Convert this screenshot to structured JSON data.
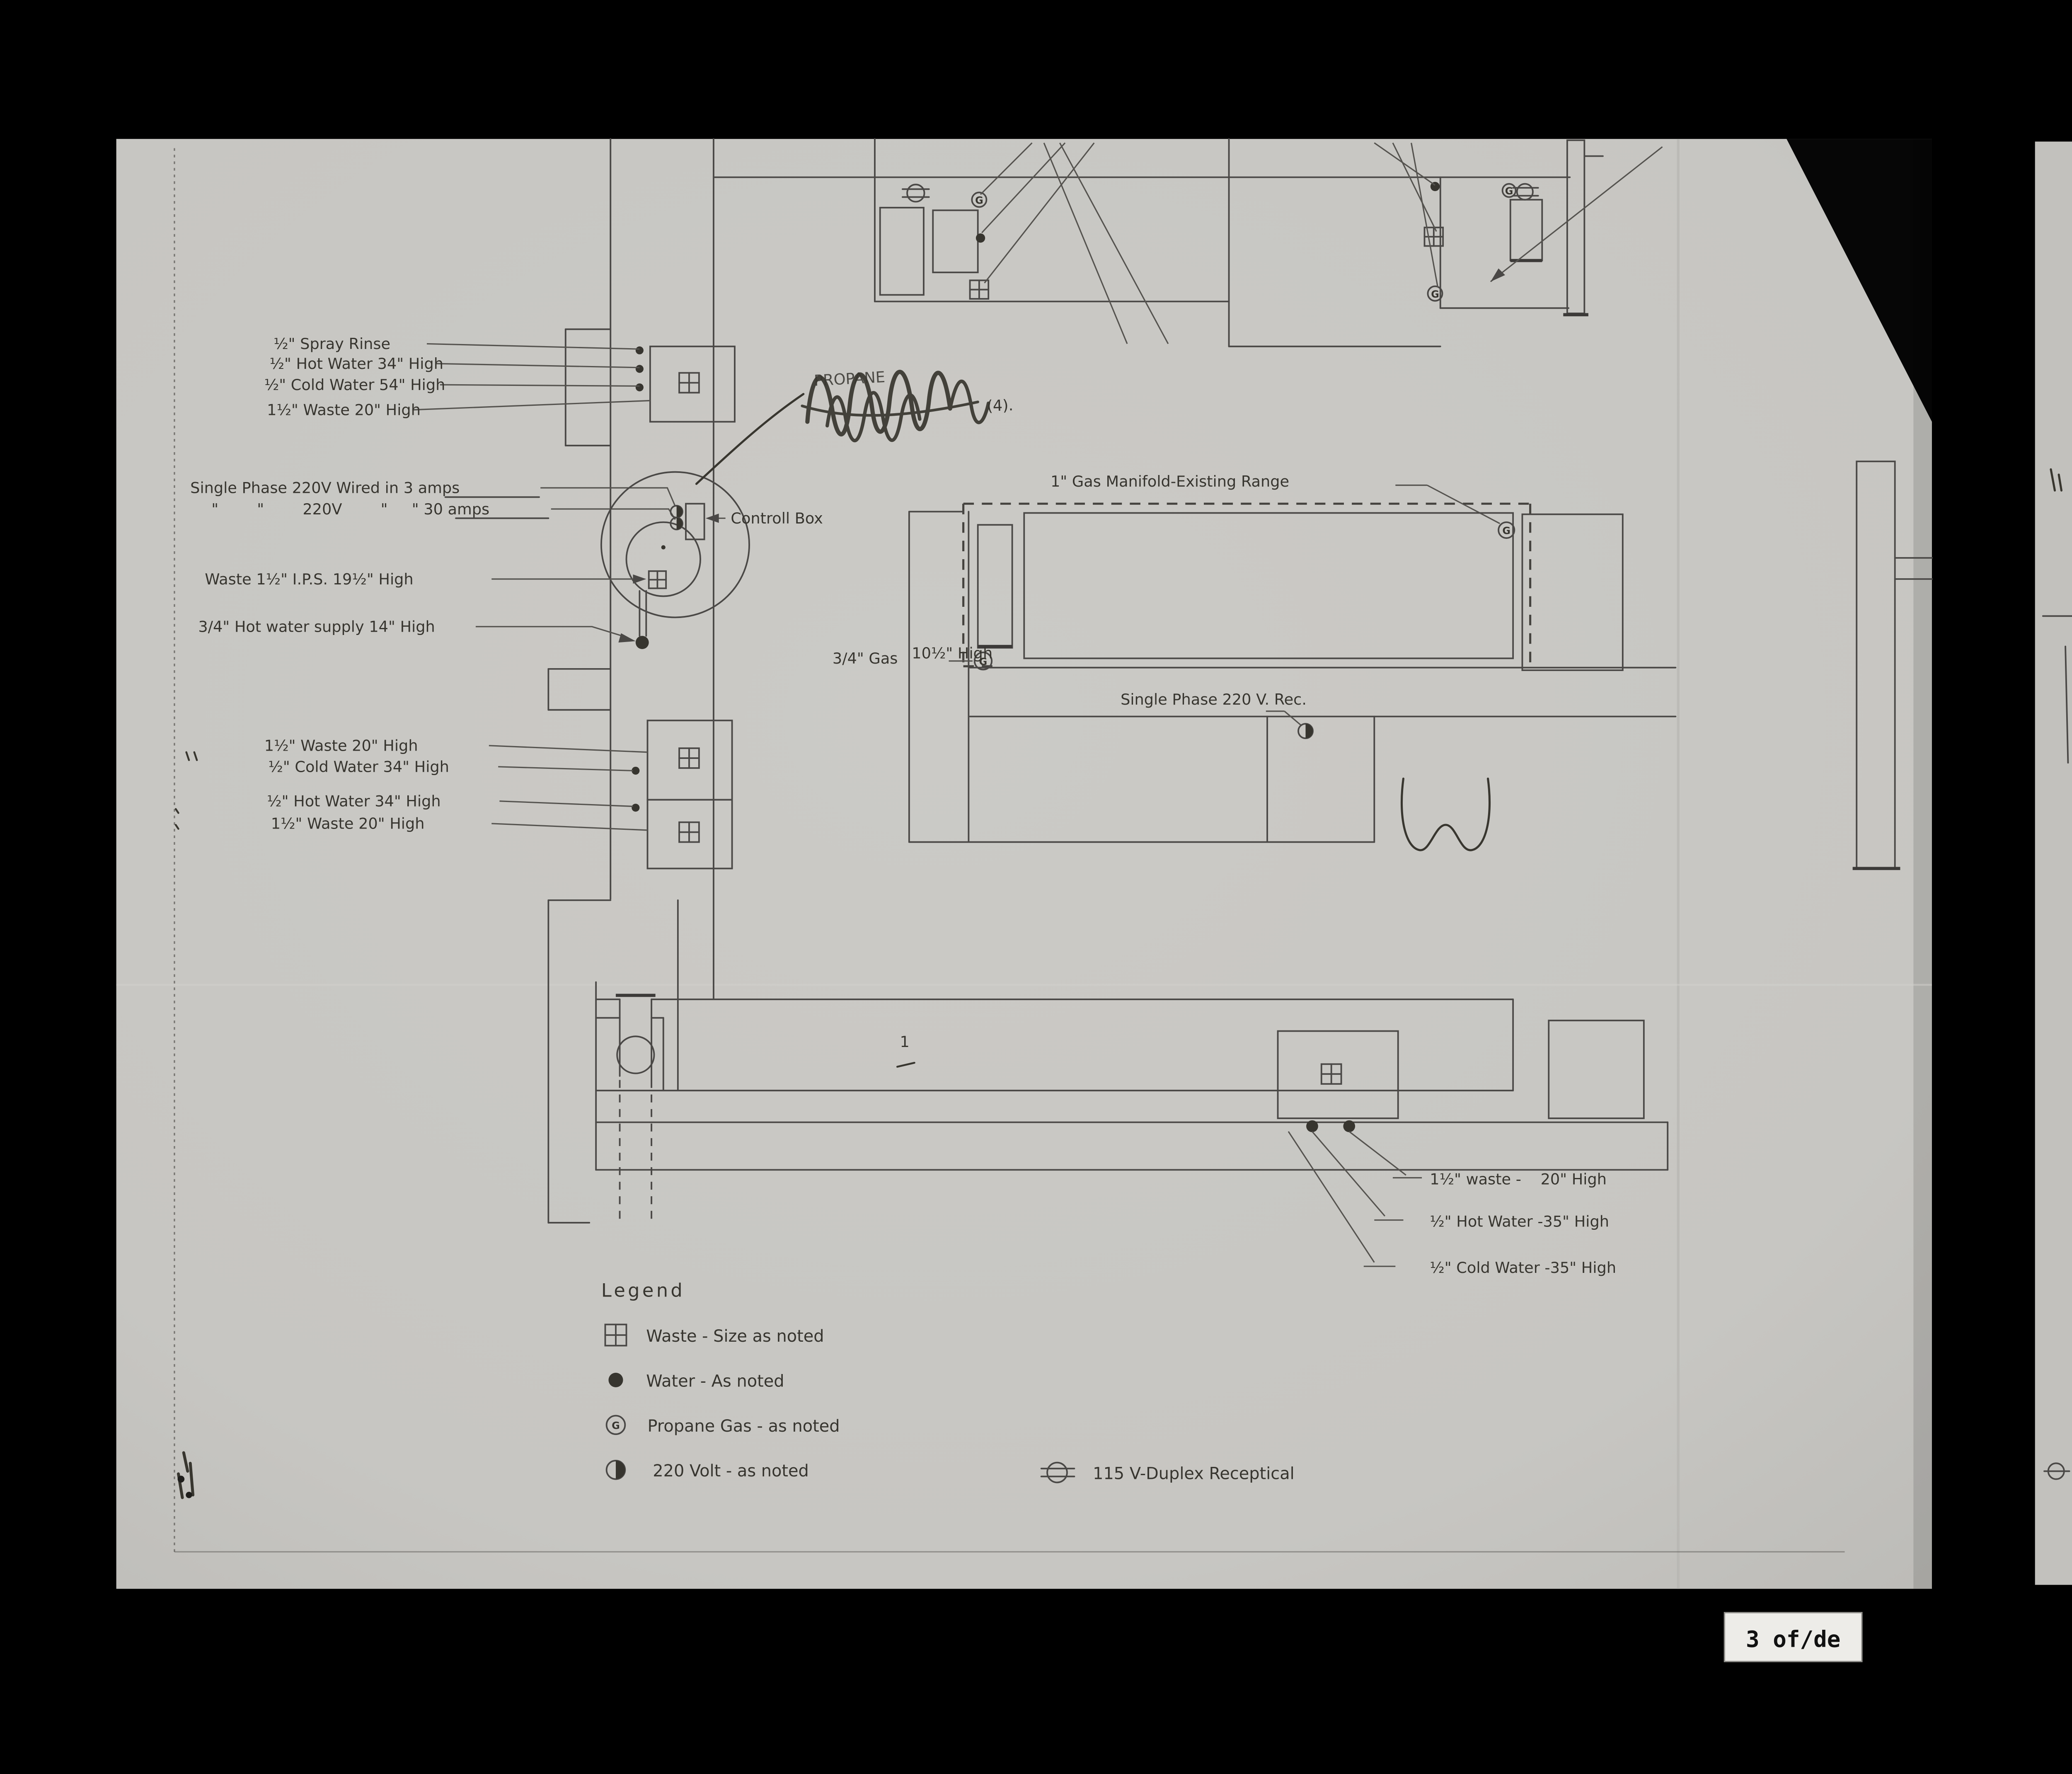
{
  "document": {
    "type": "scanned kitchen utilities rough-in plan",
    "sheet_marker": "3 of/de"
  },
  "colors": {
    "background": "#000000",
    "paper": "#c7c6c2",
    "second_sheet": "#c2c1bd",
    "line": "#4a4846",
    "text": "#37352f",
    "pencil": "#38362f",
    "badge_bg": "#edece8"
  },
  "symbols": {
    "gas_letter": "G"
  },
  "labels": {
    "spray_rinse": "½\" Spray Rinse",
    "hot_water_34": "½\" Hot Water 34\" High",
    "cold_water_54": "½\" Cold Water 54\" High",
    "waste_20_high": "1½\" Waste 20\" High",
    "single_phase_line1": "Single Phase 220V Wired in 3 amps",
    "single_phase_line2": "\"        \"        220V        \"     \" 30 amps",
    "waste_ips": "Waste 1½\" I.P.S. 19½\" High",
    "hot_water_supply": "3/4\" Hot water supply 14\" High",
    "waste_20_b": "1½\" Waste 20\" High",
    "cold_water_34": "½\" Cold Water 34\" High",
    "hot_water_34_b": "½\" Hot Water 34\" High",
    "waste_20_c": "1½\" Waste 20\" High",
    "controll_box": "Controll Box",
    "gas_manifold": "1\" Gas Manifold-Existing Range",
    "gas_34": "3/4\" Gas",
    "gas_34_high": "10½\" High",
    "single_phase_rec": "Single Phase 220 V. Rec.",
    "waste_bottom_right": "1½\" waste -    20\" High",
    "hot_water_bottom_right": "½\" Hot Water -35\" High",
    "cold_water_bottom_right": "½\" Cold Water -35\" High"
  },
  "scribble": {
    "under_text": "PROPANE",
    "suffix": "(4)."
  },
  "marks": {
    "flag": "1"
  },
  "legend": {
    "title": "Legend",
    "items": [
      {
        "symbol": "waste-icon",
        "label": "Waste - Size as noted"
      },
      {
        "symbol": "water-icon",
        "label": "Water - As noted"
      },
      {
        "symbol": "propane-gas-icon",
        "label": "Propane Gas - as noted"
      },
      {
        "symbol": "volt-220-icon",
        "label": "220 Volt - as noted"
      },
      {
        "symbol": "duplex-receptacle-icon",
        "label": "115 V-Duplex Receptical"
      }
    ]
  },
  "page_marker": {
    "text": "3 of/de"
  }
}
